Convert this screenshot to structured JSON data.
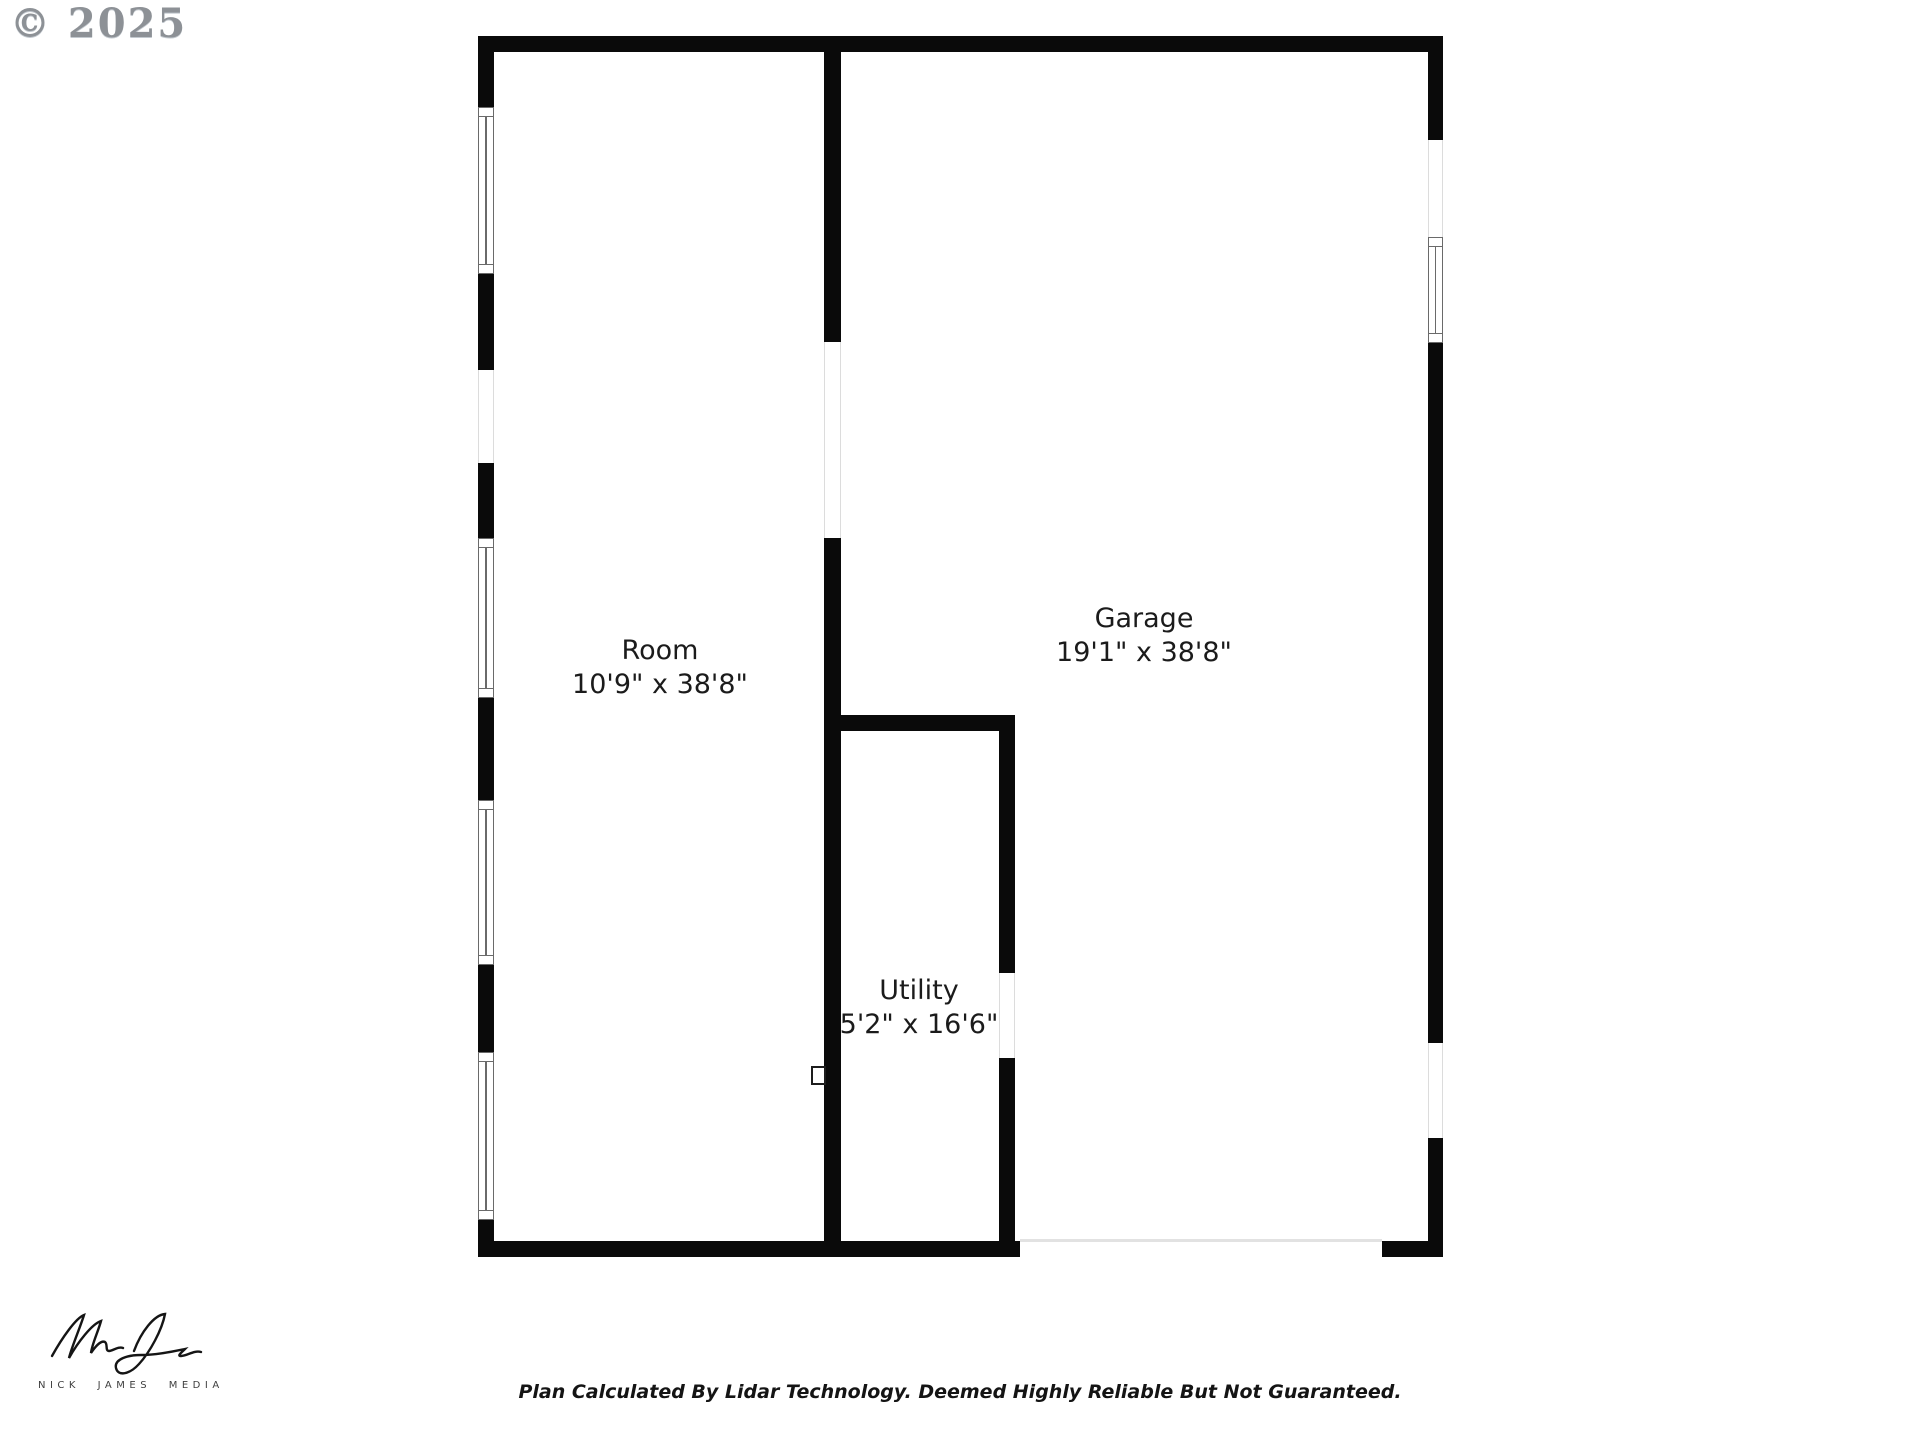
{
  "copyright": "© 2025",
  "plan": {
    "rooms": [
      {
        "name": "Room",
        "dims": "10'9\" x 38'8\""
      },
      {
        "name": "Garage",
        "dims": "19'1\" x 38'8\""
      },
      {
        "name": "Utility",
        "dims": "5'2\" x 16'6\""
      }
    ]
  },
  "footer": {
    "disclaimer": "Plan Calculated By Lidar Technology. Deemed Highly Reliable But Not Guaranteed."
  },
  "logo": {
    "text": "NICK JAMES MEDIA"
  },
  "colors": {
    "wall": "#0a0a0a",
    "window_frame": "#6a6a6a",
    "opening_edge": "#dcdcdc",
    "garage_door_line": "#e2e2e2",
    "label_text": "#1b1b1b",
    "copyright_text": "#8d9196",
    "logo_text": "#3f3f3f"
  }
}
